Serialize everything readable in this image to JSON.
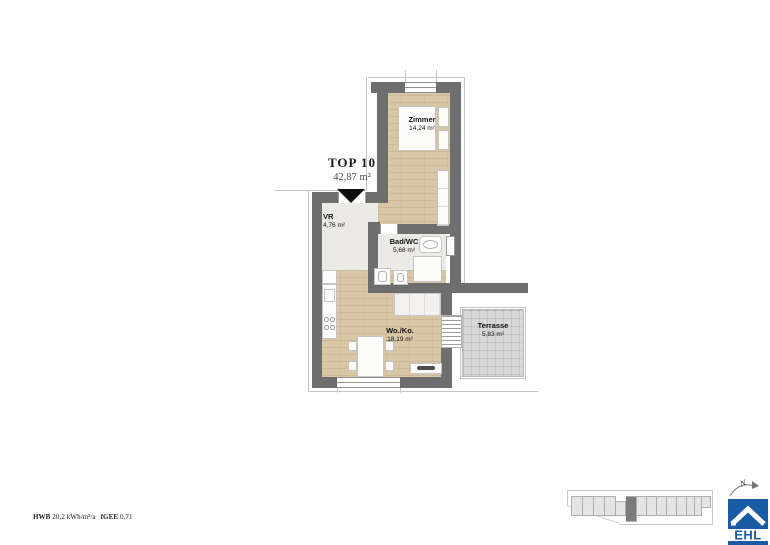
{
  "header": {
    "title": "TOP 10",
    "area": "42,87 m²"
  },
  "rooms": {
    "zimmer": {
      "label": "Zimmer",
      "area": "14,24 m²"
    },
    "vr": {
      "label": "VR",
      "area": "4,76 m²"
    },
    "bad": {
      "label": "Bad/WC",
      "area": "5,68 m²"
    },
    "woko": {
      "label": "Wo./Ko.",
      "area": "18,19 m²"
    },
    "terrasse": {
      "label": "Terrasse",
      "area": "5,83 m²"
    }
  },
  "footer": {
    "hwb_label": "HWB",
    "hwb_value": "20,2 kWh/m²/a",
    "fgee_label": "fGEE",
    "fgee_value": "0,71"
  },
  "compass": {
    "label": "N"
  },
  "logo": {
    "text": "EHL",
    "blue": "#1a5ba6"
  },
  "colors": {
    "wall": "#6e6e6e",
    "wood_floor": "#d9c6a5",
    "light_floor": "#eceae7",
    "terrace_floor": "#d8d8d8",
    "logo_blue": "#1a5ba6",
    "entry_marker": "#0d0d0d"
  },
  "site_plan": {
    "cells": [
      {
        "w": 12
      },
      {
        "w": 11
      },
      {
        "w": 11
      },
      {
        "w": 11
      },
      {
        "w": 10,
        "t": 5,
        "h": 15
      },
      {
        "w": 11,
        "dark": true,
        "h": 26
      },
      {
        "w": 10
      },
      {
        "w": 10
      },
      {
        "w": 10
      },
      {
        "w": 10
      },
      {
        "w": 10
      },
      {
        "w": 11
      }
    ],
    "annex": [
      {
        "w": 8,
        "h": 20
      },
      {
        "w": 9,
        "h": 12
      }
    ]
  }
}
